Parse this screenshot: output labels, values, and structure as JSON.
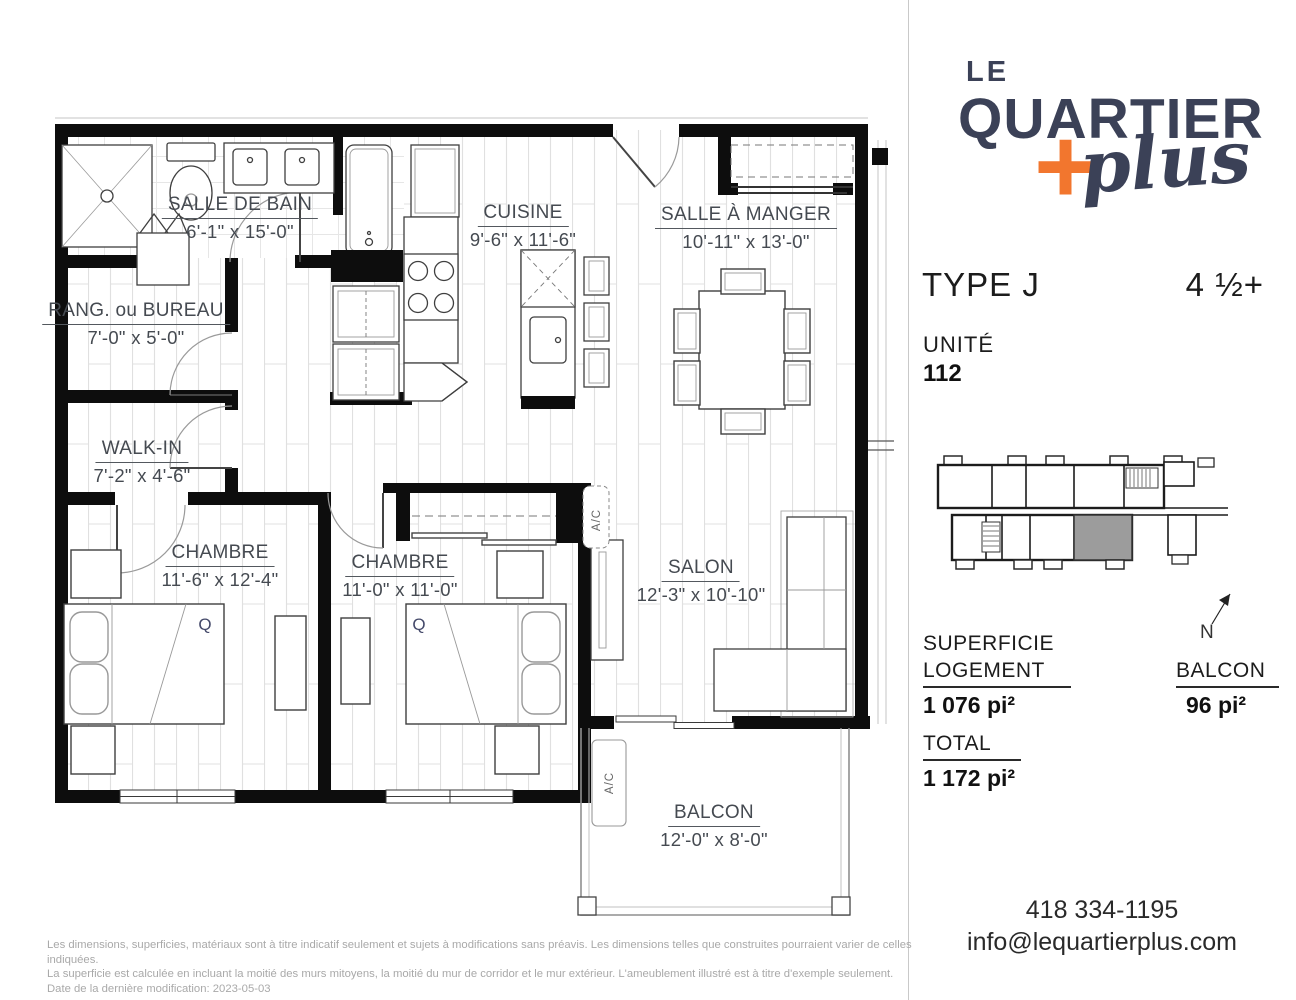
{
  "brand": {
    "le": "LE",
    "quartier": "QUARTIER",
    "plus_word": "plus",
    "plus_sign": "+",
    "colors": {
      "navy": "#3b4157",
      "orange": "#f2762e"
    }
  },
  "unit": {
    "type": "TYPE J",
    "layout": "4 ½+",
    "unite_label": "UNITÉ",
    "number": "112"
  },
  "areas": {
    "superficie_label": "SUPERFICIE",
    "logement_label": "LOGEMENT",
    "logement_value": "1 076 pi²",
    "balcon_label": "BALCON",
    "balcon_value": "96 pi²",
    "total_label": "TOTAL",
    "total_value": "1 172 pi²"
  },
  "rooms": [
    {
      "id": "salle-de-bain",
      "name": "SALLE DE BAIN",
      "dims": "6'-1\" x 15'-0\""
    },
    {
      "id": "rang-ou-bureau",
      "name": "RANG. ou BUREAU",
      "dims": "7'-0\" x 5'-0\""
    },
    {
      "id": "cuisine",
      "name": "CUISINE",
      "dims": "9'-6\" x 11'-6\""
    },
    {
      "id": "salle-a-manger",
      "name": "SALLE À MANGER",
      "dims": "10'-11\" x 13'-0\""
    },
    {
      "id": "walk-in",
      "name": "WALK-IN",
      "dims": "7'-2\" x 4'-6\""
    },
    {
      "id": "chambre-1",
      "name": "CHAMBRE",
      "dims": "11'-6\" x 12'-4\""
    },
    {
      "id": "chambre-2",
      "name": "CHAMBRE",
      "dims": "11'-0\" x 11'-0\""
    },
    {
      "id": "salon",
      "name": "SALON",
      "dims": "12'-3\" x 10'-10\""
    },
    {
      "id": "balcon",
      "name": "BALCON",
      "dims": "12'-0\" x 8'-0\""
    }
  ],
  "plan": {
    "ac_label": "A/C",
    "queen_marker": "Q",
    "north_label": "N"
  },
  "contact": {
    "phone": "418 334-1195",
    "email": "info@lequartierplus.com"
  },
  "footer": {
    "line1": "Les dimensions, superficies, matériaux sont à titre indicatif seulement et sujets à modifications sans préavis. Les dimensions telles que construites pourraient varier de celles indiquées.",
    "line2": "La superficie est calculée en incluant la moitié des murs mitoyens, la moitié du mur de corridor et le mur extérieur. L'ameublement illustré est à titre d'exemple seulement.",
    "line3": "Date de la dernière modification: 2023-05-03"
  }
}
